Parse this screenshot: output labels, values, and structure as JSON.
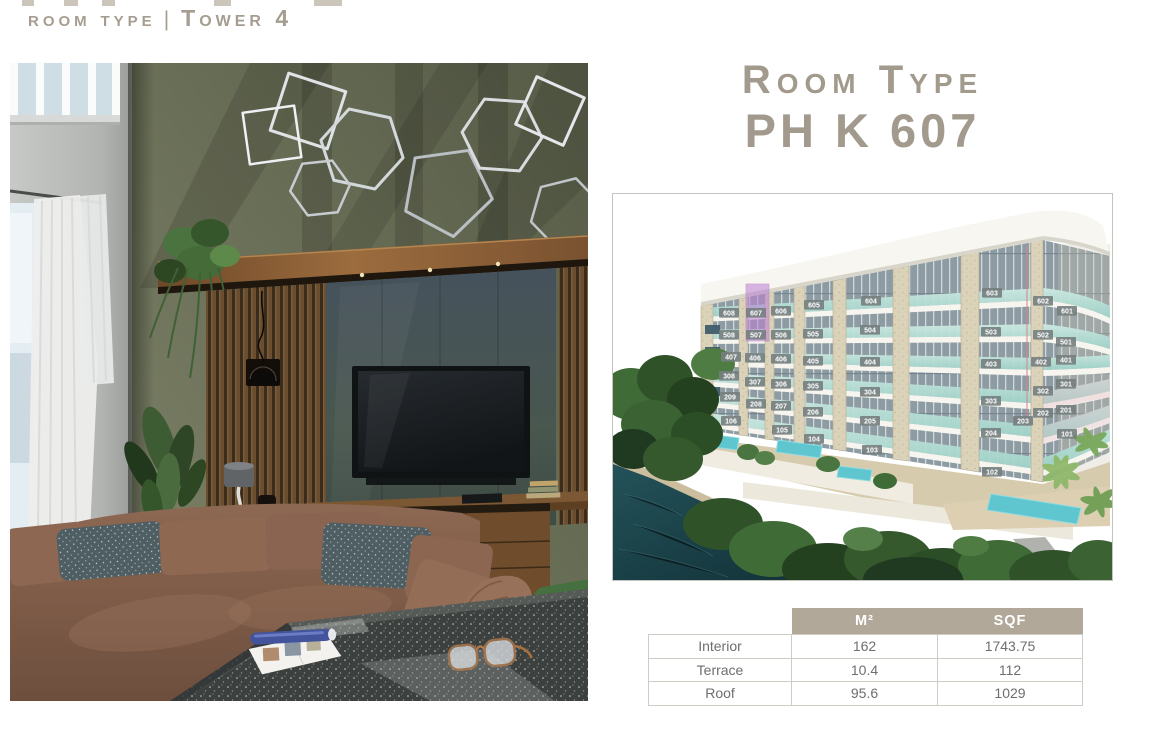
{
  "header": {
    "section": "room type",
    "divider": "|",
    "tower": "Tower 4"
  },
  "title": {
    "line1": "Room Type",
    "line2": "PH K 607"
  },
  "building_diagram": {
    "highlighted_unit": "607",
    "floors": [
      {
        "level": 6,
        "units": [
          "608",
          "607",
          "606",
          "605",
          "604",
          "603",
          "602",
          "601"
        ]
      },
      {
        "level": 5,
        "units": [
          "508",
          "507",
          "506",
          "505",
          "504",
          "503",
          "502",
          "501"
        ]
      },
      {
        "level": 4,
        "units": [
          "407",
          "406",
          "406",
          "405",
          "404",
          "403",
          "402",
          "401"
        ]
      },
      {
        "level": 3,
        "units": [
          "308",
          "307",
          "306",
          "305",
          "304",
          "303",
          "302",
          "301"
        ]
      },
      {
        "level": 2,
        "units": [
          "209",
          "208",
          "207",
          "206",
          "205",
          "204",
          "203",
          "202",
          "201"
        ]
      },
      {
        "level": 1,
        "units": [
          "106",
          "105",
          "104",
          "103",
          "102",
          "101"
        ]
      }
    ]
  },
  "area_table": {
    "columns": [
      "",
      "M²",
      "SQF"
    ],
    "rows": [
      {
        "label": "Interior",
        "m2": "162",
        "sqf": "1743.75"
      },
      {
        "label": "Terrace",
        "m2": "10.4",
        "sqf": "112"
      },
      {
        "label": "Roof",
        "m2": "95.6",
        "sqf": "1029"
      }
    ]
  },
  "colors": {
    "accent_text": "#a29a8c",
    "table_header_bg": "#b1a899",
    "unit_highlight": "#bb7fd4",
    "glass_teal": "#aed8d0",
    "pool": "#5fc6cf",
    "water": "#1e4a52"
  }
}
